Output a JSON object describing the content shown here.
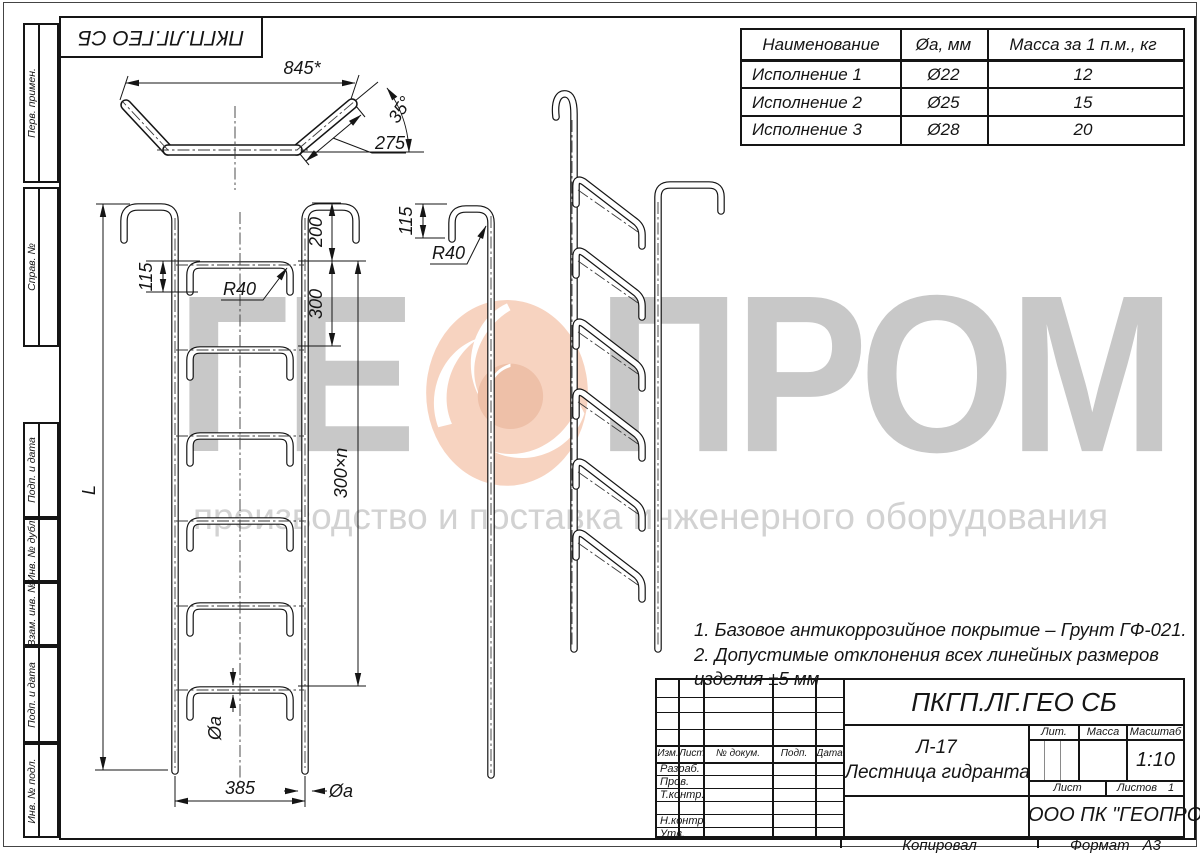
{
  "stamp": {
    "code": "ПКГП.ЛГ.ГЕО СБ",
    "doc_number": "Л-17",
    "doc_name": "Лестница гидранта",
    "company": "ООО ПК \"ГЕОПРОМ\"",
    "columns": {
      "izm": "Изм.",
      "list": "Лист",
      "doc": "№ докум.",
      "podp": "Подп.",
      "data": "Дата"
    },
    "rows": {
      "razrab": "Разраб.",
      "prov": "Пров.",
      "tkontr": "Т.контр.",
      "nkontr": "Н.контр.",
      "utv": "Утв."
    },
    "lit": "Лит.",
    "massa": "Масса",
    "masshtab": "Масштаб",
    "scale": "1:10",
    "list_label": "Лист",
    "listov_label": "Листов",
    "listov_value": "1"
  },
  "footer": {
    "kopiroval": "Копировал",
    "format_label": "Формат",
    "format_value": "А3"
  },
  "margin_stamps": {
    "s1": "Перв. примен.",
    "s2": "Справ. №",
    "s3": "Подп. и дата",
    "s4": "Инв. № дубл.",
    "s5": "Взам. инв. №",
    "s6": "Подп. и дата",
    "s7": "Инв. № подл."
  },
  "spec_table": {
    "h1": "Наименование",
    "h2": "Øа, мм",
    "h3": "Масса за 1 п.м., кг",
    "rows": [
      {
        "name": "Исполнение 1",
        "d": "Ø22",
        "m": "12"
      },
      {
        "name": "Исполнение 2",
        "d": "Ø25",
        "m": "15"
      },
      {
        "name": "Исполнение 3",
        "d": "Ø28",
        "m": "20"
      }
    ]
  },
  "notes": {
    "n1": "1. Базовое антикоррозийное покрытие – Грунт ГФ-021.",
    "n2": "2. Допустимые отклонения всех линейных размеров изделия ±5 мм"
  },
  "dims": {
    "d845": "845*",
    "a35": "35°",
    "d275": "275",
    "l": "L",
    "d115": "115",
    "d200": "200",
    "d300": "300",
    "d300n": "300×n",
    "d385": "385",
    "r40": "R40",
    "da": "Øа"
  },
  "watermark": {
    "left": "ГЕ",
    "right": "ПРОМ",
    "slogan": "производство и поставка инженерного оборудования"
  },
  "colors": {
    "line": "#151515",
    "watermark_text": "#c8c8c8",
    "logo_peach": "#f7d3c0",
    "logo_inner": "#eec0a8"
  }
}
